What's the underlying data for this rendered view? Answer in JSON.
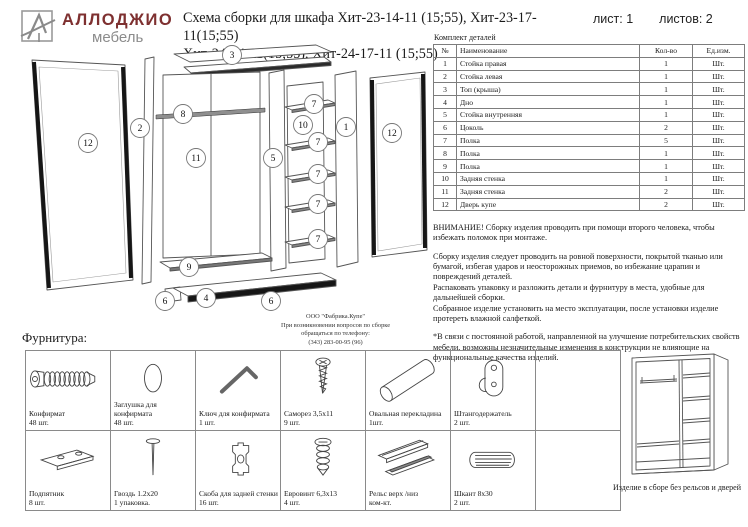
{
  "header": {
    "brand_name": "АЛЛОДЖИО",
    "brand_sub": "мебель",
    "title_line1": "Схема сборки для шкафа Хит-23-14-11 (15;55), Хит-23-17-11(15;55)",
    "title_line2": "Хит-24-14-11(15;55), Хит-24-17-11 (15;55)",
    "sheet_label": "лист: 1",
    "sheets_label": "листов: 2"
  },
  "parts_table": {
    "caption": "Комплект деталей",
    "headers": [
      "№",
      "Наименование",
      "Кол-во",
      "Ед.изм."
    ],
    "rows": [
      [
        "1",
        "Стойка правая",
        "1",
        "Шт."
      ],
      [
        "2",
        "Стойка левая",
        "1",
        "Шт."
      ],
      [
        "3",
        "Топ (крыша)",
        "1",
        "Шт."
      ],
      [
        "4",
        "Дно",
        "1",
        "Шт."
      ],
      [
        "5",
        "Стойка внутренняя",
        "1",
        "Шт."
      ],
      [
        "6",
        "Цоколь",
        "2",
        "Шт."
      ],
      [
        "7",
        "Полка",
        "5",
        "Шт."
      ],
      [
        "8",
        "Полка",
        "1",
        "Шт."
      ],
      [
        "9",
        "Полка",
        "1",
        "Шт."
      ],
      [
        "10",
        "Задняя стенка",
        "1",
        "Шт."
      ],
      [
        "11",
        "Задняя стенка",
        "2",
        "Шт."
      ],
      [
        "12",
        "Дверь купе",
        "2",
        "Шт."
      ]
    ]
  },
  "notes": {
    "warning": "ВНИМАНИЕ! Сборку изделия проводить при помощи второго человека, чтобы избежать поломок при монтаже.",
    "p1": "Сборку изделия следует проводить на ровной поверхности, покрытой тканью или бумагой, избегая ударов и неосторожных приемов, во избежание царапин и повреждений деталей.",
    "p2": "Распаковать упаковку и разложить детали и фурнитуру в места, удобные для дальнейшей сборки.",
    "p3": "Собранное изделие установить на место эксплуатации, после установки изделие протереть влажной салфеткой.",
    "p4": "*В связи с постоянной работой, направленной на улучшение потребительских свойств мебели, возможны незначительные изменения в конструкции не влияющие на функциональные качества изделий."
  },
  "factory_note": {
    "line1": "ООО \"Фабрика.Купе\"",
    "line2": "При возникновении вопросов по сборке",
    "line3": "обращаться по телефону:",
    "line4": "(343) 283-00-95 (96)"
  },
  "diagram": {
    "callouts": [
      {
        "n": "3",
        "x": 214,
        "y": 13
      },
      {
        "n": "12",
        "x": 70,
        "y": 101
      },
      {
        "n": "2",
        "x": 122,
        "y": 86
      },
      {
        "n": "8",
        "x": 165,
        "y": 72
      },
      {
        "n": "11",
        "x": 178,
        "y": 116
      },
      {
        "n": "5",
        "x": 255,
        "y": 116
      },
      {
        "n": "7",
        "x": 296,
        "y": 62
      },
      {
        "n": "10",
        "x": 285,
        "y": 83
      },
      {
        "n": "1",
        "x": 328,
        "y": 85
      },
      {
        "n": "12",
        "x": 374,
        "y": 91
      },
      {
        "n": "7",
        "x": 300,
        "y": 100
      },
      {
        "n": "7",
        "x": 300,
        "y": 132
      },
      {
        "n": "7",
        "x": 300,
        "y": 162
      },
      {
        "n": "7",
        "x": 300,
        "y": 197
      },
      {
        "n": "9",
        "x": 171,
        "y": 225
      },
      {
        "n": "6",
        "x": 147,
        "y": 259
      },
      {
        "n": "4",
        "x": 188,
        "y": 256
      },
      {
        "n": "6",
        "x": 253,
        "y": 259
      }
    ]
  },
  "hardware": {
    "section_label": "Фурнитура:",
    "items": [
      {
        "name": "Конфирмат",
        "qty": "48 шт.",
        "icon": "confirmat-screw-icon"
      },
      {
        "name": "Заглушка для конфирмата",
        "qty": "48 шт.",
        "icon": "plug-icon"
      },
      {
        "name": "Ключ для конфирмата",
        "qty": "1 шт.",
        "icon": "hex-key-icon"
      },
      {
        "name": "Саморез 3,5х11",
        "qty": "9 шт.",
        "icon": "screw-icon"
      },
      {
        "name": "Овальная перекладина",
        "qty": "1шт.",
        "icon": "oval-rod-icon"
      },
      {
        "name": "Штангодержатель",
        "qty": "2 шт.",
        "icon": "rod-holder-icon"
      },
      {
        "name": "Подпятник",
        "qty": "8 шт.",
        "icon": "foot-pad-icon"
      },
      {
        "name": "Гвоздь 1.2х20",
        "qty": "1 упаковка.",
        "icon": "nail-icon"
      },
      {
        "name": "Скоба для задней стенки",
        "qty": "16 шт.",
        "icon": "bracket-icon"
      },
      {
        "name": "Евровинт 6,3х13",
        "qty": "4 шт.",
        "icon": "euro-screw-icon"
      },
      {
        "name": "Рельс верх /низ",
        "qty": "ком-кт.",
        "icon": "rail-icon"
      },
      {
        "name": "Шкант 8х30",
        "qty": "2 шт.",
        "icon": "dowel-icon"
      }
    ]
  },
  "assembled": {
    "caption": "Изделие в сборе без рельсов и дверей"
  },
  "colors": {
    "brand_red": "#7e3030",
    "brand_gray": "#8c8c8c",
    "line_gray": "#555555",
    "dark_edge": "#161616"
  }
}
